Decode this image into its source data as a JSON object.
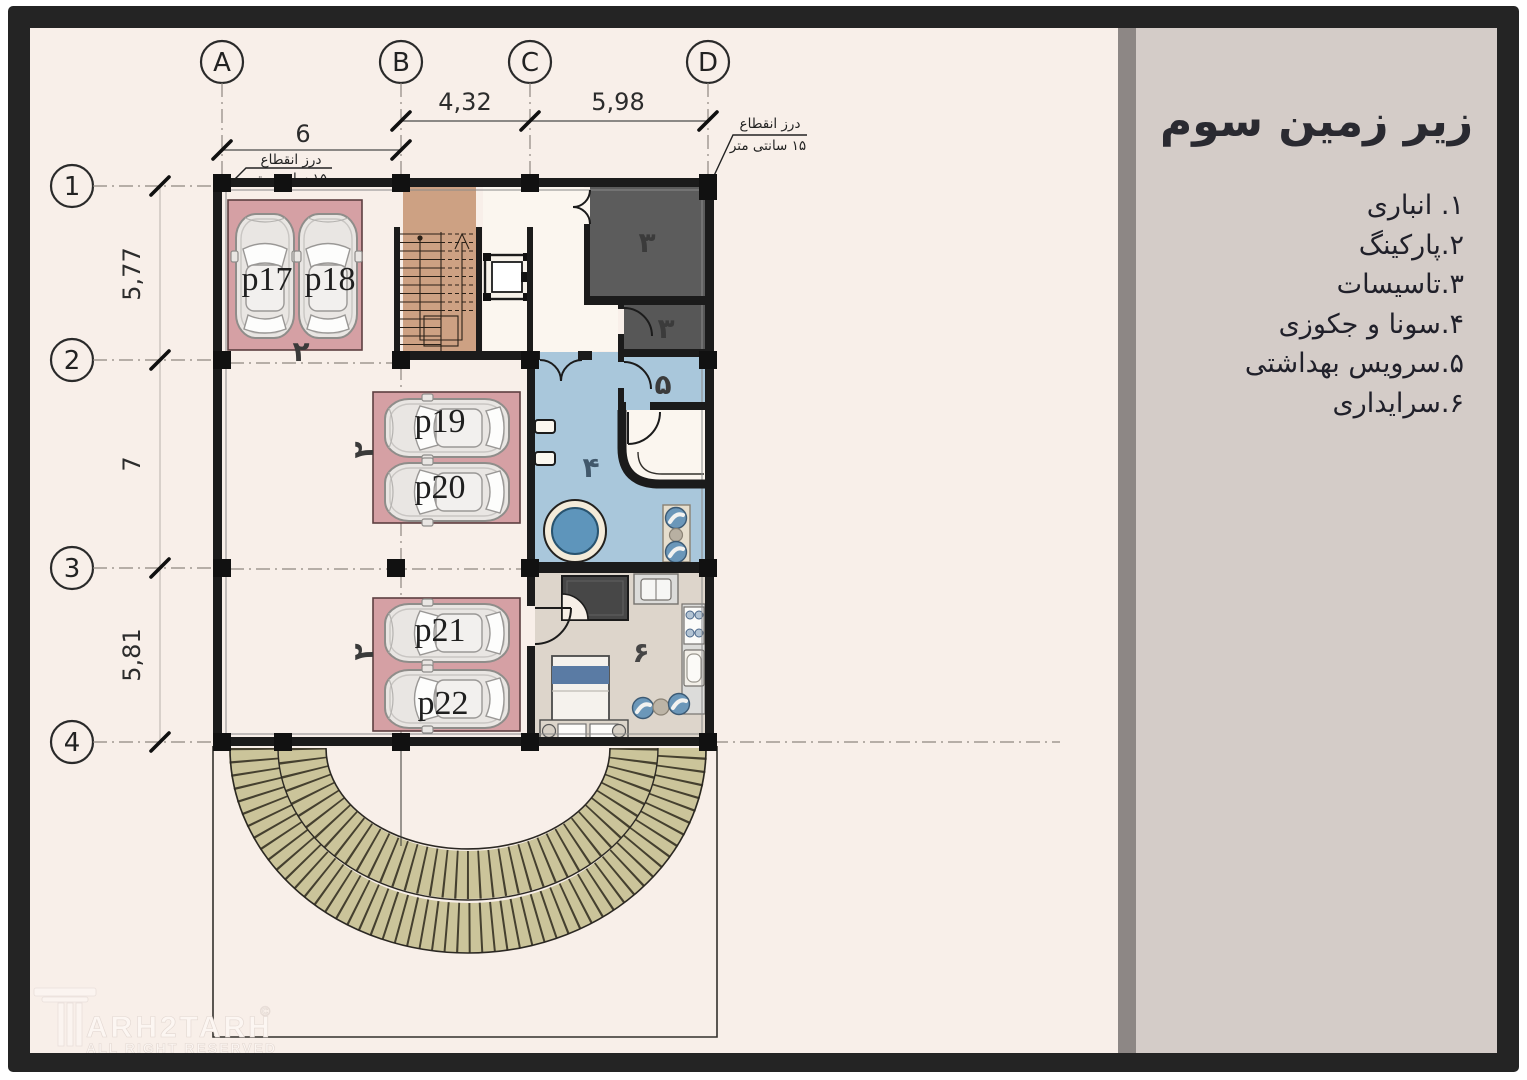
{
  "panel": {
    "title": "زیر زمین سوم",
    "legend": [
      "۱. انباری",
      "۲.پارکینگ",
      "۳.تاسیسات",
      "۴.سونا و جکوزی",
      "۵.سرویس بهداشتی",
      "۶.سرایداری"
    ]
  },
  "grid": {
    "cols": [
      "A",
      "B",
      "C",
      "D"
    ],
    "rows": [
      "1",
      "2",
      "3",
      "4"
    ]
  },
  "dims": {
    "top": [
      "6",
      "4,32",
      "5,98"
    ],
    "left": [
      "5,77",
      "7",
      "5,81"
    ]
  },
  "notes": {
    "joint": "درز انقطاع",
    "joint_size": "۱۵ سانتی متر"
  },
  "parking": {
    "labels": [
      "p17",
      "p18",
      "p19",
      "p20",
      "p21",
      "p22"
    ],
    "zone": "۲"
  },
  "rooms": {
    "facilities": "۳",
    "sauna": "۴",
    "wc": "۵",
    "janitor": "۶"
  },
  "logo": {
    "name": "ARH2TARH",
    "copyright": "©",
    "tagline": "ALL RIGHT RESERVED"
  },
  "colors": {
    "frame": "#242424",
    "plan_bg": "#f8efe9",
    "panel_bg": "#d4ccc8",
    "divider": "#8d8785",
    "wall": "#1b1b1b",
    "parking_pad": "#d5a0a4",
    "stairs": "#cda183",
    "dark_room": "#5c5c5c",
    "sauna_room": "#a9c7db",
    "pool": "#5e95bb",
    "janitor_room": "#ddd5cb",
    "ramp": "#cbc49a"
  }
}
